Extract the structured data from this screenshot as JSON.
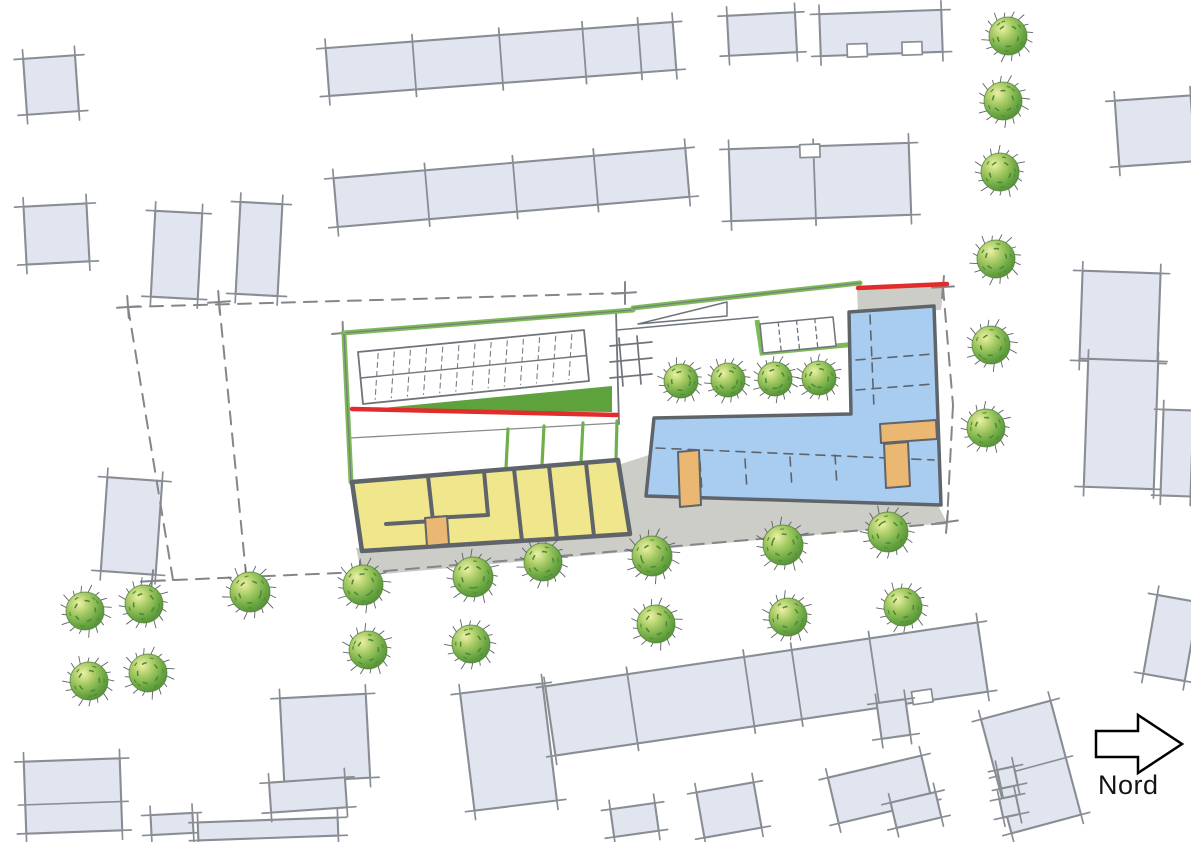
{
  "north": {
    "label": "Nord"
  },
  "palette": {
    "bg": "#ffffff",
    "building_fill": "#e1e5ef",
    "building_stroke": "#898d94",
    "wall": "#5f646b",
    "yellow": "#f0e78d",
    "blue": "#a9cdf1",
    "paving": "#cdcdc7",
    "grass": "#5da23d",
    "green_line": "#7cbb58",
    "green_div": "#6fb04c",
    "red": "#e22b2b",
    "orange": "#eab873",
    "dash": "#83868b",
    "thin": "#7a7d82",
    "tree_dark": "#4e8c33",
    "tree_mid": "#84b952",
    "tree_light": "#edf0a5",
    "spike": "#5d6167"
  },
  "plan": {
    "canvas": {
      "w": 1191,
      "h": 842
    },
    "context_buildings": [
      {
        "x": 25,
        "y": 57,
        "w": 52,
        "h": 56,
        "rot": -4
      },
      {
        "x": 25,
        "y": 205,
        "w": 63,
        "h": 58,
        "rot": -3
      },
      {
        "x": 153,
        "y": 212,
        "w": 47,
        "h": 86,
        "rot": 3
      },
      {
        "x": 238,
        "y": 203,
        "w": 42,
        "h": 92,
        "rot": 3
      },
      {
        "x": 327,
        "y": 35,
        "w": 348,
        "h": 48,
        "rot": -4.3,
        "div": [
          0.25,
          0.5,
          0.74,
          0.9
        ]
      },
      {
        "x": 335,
        "y": 163,
        "w": 353,
        "h": 49,
        "rot": -4.9,
        "div": [
          0.26,
          0.51,
          0.74
        ]
      },
      {
        "x": 728,
        "y": 14,
        "w": 68,
        "h": 40,
        "rot": -3
      },
      {
        "x": 820,
        "y": 12,
        "w": 122,
        "h": 42,
        "rot": -2,
        "notchB": [
          0.3,
          0.75
        ]
      },
      {
        "x": 730,
        "y": 146,
        "w": 180,
        "h": 72,
        "rot": -2,
        "div": [
          0.47
        ],
        "notchT": [
          0.45
        ]
      },
      {
        "x": 1117,
        "y": 98,
        "w": 76,
        "h": 66,
        "rot": -4
      },
      {
        "x": 1081,
        "y": 272,
        "w": 78,
        "h": 90,
        "rot": 2
      },
      {
        "x": 1086,
        "y": 360,
        "w": 70,
        "h": 128,
        "rot": 2
      },
      {
        "x": 1162,
        "y": 410,
        "w": 30,
        "h": 86,
        "rot": 2
      },
      {
        "x": 104,
        "y": 479,
        "w": 55,
        "h": 94,
        "rot": 4
      },
      {
        "x": 25,
        "y": 760,
        "w": 96,
        "h": 72,
        "rot": -2,
        "divH": [
          0.6
        ]
      },
      {
        "x": 151,
        "y": 814,
        "w": 42,
        "h": 20,
        "rot": -3
      },
      {
        "x": 198,
        "y": 820,
        "w": 140,
        "h": 18,
        "rot": -2
      },
      {
        "x": 282,
        "y": 696,
        "w": 86,
        "h": 84,
        "rot": -3
      },
      {
        "x": 270,
        "y": 780,
        "w": 76,
        "h": 30,
        "rot": -4
      },
      {
        "x": 467,
        "y": 688,
        "w": 83,
        "h": 118,
        "rot": -7
      },
      {
        "x": 548,
        "y": 654,
        "w": 437,
        "h": 70,
        "rot": -8.4,
        "div": [
          0.19,
          0.46,
          0.57,
          0.75
        ],
        "notchB": [
          0.85
        ]
      },
      {
        "x": 879,
        "y": 701,
        "w": 29,
        "h": 36,
        "rot": -8
      },
      {
        "x": 832,
        "y": 766,
        "w": 96,
        "h": 47,
        "rot": -13.3
      },
      {
        "x": 893,
        "y": 797,
        "w": 46,
        "h": 26,
        "rot": -13.3
      },
      {
        "x": 995,
        "y": 708,
        "w": 72,
        "h": 118,
        "rot": -15,
        "divH": [
          0.5
        ]
      },
      {
        "x": 999,
        "y": 768,
        "w": 17,
        "h": 19,
        "rot": -12
      },
      {
        "x": 1001,
        "y": 797,
        "w": 17,
        "h": 19,
        "rot": -12
      },
      {
        "x": 1150,
        "y": 598,
        "w": 42,
        "h": 80,
        "rot": 10
      },
      {
        "x": 700,
        "y": 787,
        "w": 58,
        "h": 46,
        "rot": -10
      },
      {
        "x": 612,
        "y": 806,
        "w": 45,
        "h": 28,
        "rot": -8
      }
    ],
    "trees": [
      [
        681,
        381,
        17
      ],
      [
        728,
        380,
        17
      ],
      [
        775,
        379,
        17
      ],
      [
        819,
        378,
        17
      ],
      [
        1008,
        36,
        19
      ],
      [
        1003,
        101,
        19
      ],
      [
        1000,
        172,
        19
      ],
      [
        996,
        259,
        19
      ],
      [
        991,
        345,
        19
      ],
      [
        986,
        428,
        19
      ],
      [
        250,
        592,
        20
      ],
      [
        363,
        585,
        20
      ],
      [
        473,
        577,
        20
      ],
      [
        543,
        562,
        19
      ],
      [
        652,
        556,
        20
      ],
      [
        783,
        545,
        20
      ],
      [
        888,
        532,
        20
      ],
      [
        85,
        611,
        19
      ],
      [
        144,
        604,
        19
      ],
      [
        89,
        681,
        19
      ],
      [
        148,
        673,
        19
      ],
      [
        368,
        650,
        19
      ],
      [
        471,
        644,
        19
      ],
      [
        656,
        624,
        19
      ],
      [
        788,
        617,
        19
      ],
      [
        903,
        607,
        19
      ]
    ],
    "site": {
      "gray_areas": [
        [
          [
            356,
            548
          ],
          [
            628,
            530
          ],
          [
            641,
            496
          ],
          [
            938,
            505
          ],
          [
            947,
            523
          ],
          [
            362,
            576
          ]
        ],
        [
          [
            621,
            464
          ],
          [
            658,
            452
          ],
          [
            650,
            505
          ],
          [
            627,
            533
          ]
        ],
        [
          [
            857,
            290
          ],
          [
            944,
            286
          ],
          [
            941,
            310
          ],
          [
            858,
            312
          ]
        ]
      ],
      "dashed": [
        [
          [
            128,
            307
          ],
          [
            625,
            293
          ]
        ],
        [
          [
            128,
            307
          ],
          [
            173,
            580
          ]
        ],
        [
          [
            219,
            302
          ],
          [
            247,
            584
          ]
        ],
        [
          [
            152,
            581
          ],
          [
            362,
            572
          ]
        ],
        [
          [
            362,
            573
          ],
          [
            947,
            523
          ]
        ],
        [
          [
            943,
            287
          ],
          [
            953,
            405
          ]
        ],
        [
          [
            953,
            405
          ],
          [
            947,
            522
          ]
        ]
      ],
      "crosses": [
        [
          128,
          307,
          -4,
          86
        ],
        [
          219,
          302,
          -4,
          86
        ],
        [
          247,
          584,
          -3,
          84
        ],
        [
          152,
          581,
          -3,
          96
        ],
        [
          362,
          572,
          -5,
          80
        ],
        [
          943,
          287,
          -3,
          95
        ],
        [
          947,
          522,
          -8,
          95
        ],
        [
          625,
          293,
          -4,
          90
        ],
        [
          343,
          333,
          -5,
          88
        ]
      ],
      "parking": {
        "outline": [
          [
            358,
            352
          ],
          [
            584,
            330
          ],
          [
            589,
            381
          ],
          [
            363,
            404
          ]
        ],
        "stalls": 13
      },
      "divider_line": [
        [
          616,
          312
        ],
        [
          619,
          424
        ]
      ],
      "courtyard_line": [
        [
          350,
          438
        ],
        [
          618,
          423
        ]
      ],
      "pergola": [
        [
          [
            610,
            346
          ],
          [
            652,
            342
          ]
        ],
        [
          [
            610,
            362
          ],
          [
            652,
            358
          ]
        ],
        [
          [
            610,
            378
          ],
          [
            652,
            374
          ]
        ],
        [
          [
            619,
            338
          ],
          [
            623,
            386
          ]
        ],
        [
          [
            637,
            336
          ],
          [
            641,
            384
          ]
        ]
      ],
      "ramp": {
        "tri": [
          [
            638,
            324
          ],
          [
            727,
            302
          ],
          [
            727,
            316
          ]
        ],
        "base": [
          [
            617,
            330
          ],
          [
            758,
            317
          ]
        ]
      },
      "stairs": {
        "outline": [
          [
            760,
            324
          ],
          [
            833,
            317
          ],
          [
            836,
            346
          ],
          [
            763,
            353
          ]
        ],
        "divs": [
          0.25,
          0.5,
          0.75
        ],
        "greenL": [
          [
            757,
            320
          ],
          [
            762,
            353
          ],
          [
            857,
            344
          ]
        ]
      },
      "grass_wedge": [
        [
          362,
          410
        ],
        [
          612,
          386
        ],
        [
          612,
          412
        ]
      ],
      "red_lines": [
        [
          [
            352,
            409
          ],
          [
            617,
            415
          ]
        ],
        [
          [
            858,
            288
          ],
          [
            947,
            284
          ]
        ]
      ],
      "green_lines": [
        [
          [
            343,
            333
          ],
          [
            633,
            310
          ]
        ],
        [
          [
            633,
            308
          ],
          [
            860,
            283
          ]
        ],
        [
          [
            344,
            334
          ],
          [
            351,
            482
          ]
        ]
      ],
      "courtyard_greens": [
        [
          [
            508,
            429
          ],
          [
            506,
            468
          ]
        ],
        [
          [
            544,
            426
          ],
          [
            542,
            465
          ]
        ],
        [
          [
            583,
            423
          ],
          [
            581,
            462
          ]
        ],
        [
          [
            617,
            421
          ],
          [
            616,
            459
          ]
        ]
      ],
      "yellow_building": {
        "outline": [
          [
            352,
            482
          ],
          [
            618,
            460
          ],
          [
            630,
            534
          ],
          [
            362,
            551
          ]
        ],
        "walls": [
          [
            [
              428,
              476
            ],
            [
              433,
              521
            ]
          ],
          [
            [
              386,
              524
            ],
            [
              433,
              521
            ]
          ],
          [
            [
              484,
              471
            ],
            [
              488,
              515
            ]
          ],
          [
            [
              433,
              518
            ],
            [
              488,
              515
            ]
          ],
          [
            [
              514,
              469
            ],
            [
              522,
              541
            ]
          ],
          [
            [
              549,
              466
            ],
            [
              557,
              539
            ]
          ],
          [
            [
              586,
              463
            ],
            [
              594,
              536
            ]
          ]
        ],
        "door": [
          [
            425,
            518
          ],
          [
            447,
            516
          ],
          [
            449,
            544
          ],
          [
            427,
            546
          ]
        ]
      },
      "blue_building": {
        "outline": [
          [
            654,
            418
          ],
          [
            851,
            414
          ],
          [
            849,
            312
          ],
          [
            934,
            306
          ],
          [
            941,
            505
          ],
          [
            646,
            496
          ]
        ],
        "dashes": [
          [
            [
              656,
              448
            ],
            [
              934,
              460
            ]
          ],
          [
            [
              856,
              360
            ],
            [
              933,
              354
            ]
          ],
          [
            [
              856,
              390
            ],
            [
              933,
              384
            ]
          ],
          [
            [
              870,
              315
            ],
            [
              874,
              408
            ]
          ],
          [
            [
              700,
              462
            ],
            [
              702,
              492
            ]
          ],
          [
            [
              745,
              459
            ],
            [
              747,
              490
            ]
          ],
          [
            [
              790,
              457
            ],
            [
              792,
              488
            ]
          ],
          [
            [
              835,
              455
            ],
            [
              837,
              486
            ]
          ]
        ],
        "doors": [
          [
            [
              678,
              452
            ],
            [
              699,
              450
            ],
            [
              701,
              505
            ],
            [
              680,
              507
            ]
          ],
          [
            [
              880,
              424
            ],
            [
              936,
              420
            ],
            [
              937,
              439
            ],
            [
              881,
              443
            ]
          ],
          [
            [
              884,
              444
            ],
            [
              908,
              442
            ],
            [
              910,
              486
            ],
            [
              886,
              488
            ]
          ]
        ]
      }
    }
  }
}
